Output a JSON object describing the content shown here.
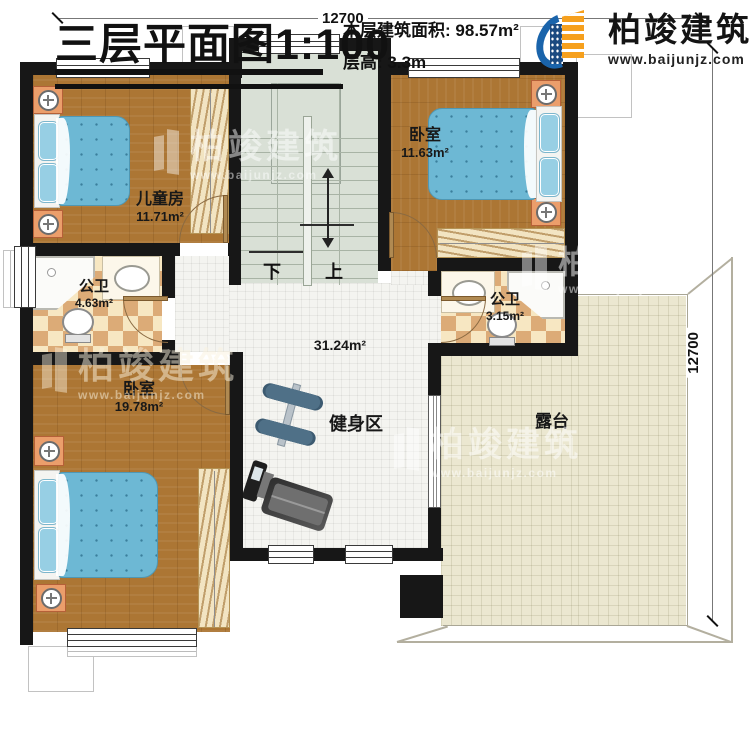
{
  "dimensions": {
    "top": "12700",
    "right": "12700"
  },
  "rooms": {
    "kids": {
      "name": "儿童房",
      "area": "11.71m²"
    },
    "bedroom_tr": {
      "name": "卧室",
      "area": "11.63m²"
    },
    "bath_left": {
      "name": "公卫",
      "area": "4.63m²"
    },
    "bath_right": {
      "name": "公卫",
      "area": "3.15m²"
    },
    "hall": {
      "area": "31.24m²",
      "zone": "健身区"
    },
    "bedroom_bl": {
      "name": "卧室",
      "area": "19.78m²"
    },
    "terrace": {
      "name": "露台"
    }
  },
  "stairs": {
    "down": "下",
    "up": "上"
  },
  "title_block": {
    "title": "三层平面图",
    "scale": "1:100",
    "area_label": "本层建筑面积:",
    "area_value": "98.57m²",
    "height_label": "层高:",
    "height_value": "3.3m"
  },
  "brand": {
    "name": "柏竣建筑",
    "website": "www.baijunjz.com"
  },
  "colors": {
    "wall": "#171717",
    "wood": "#ac7634",
    "bath_tile_light": "#f7e7c2",
    "bath_tile_dark": "#dcab77",
    "hall_tile": "#f4f4f0",
    "terrace_tile": "#ebe7d0",
    "stair_floor": "#d9e0d6",
    "bed_blue": "#6db8d4",
    "nightstand_orange": "#eb9e6b",
    "brand_blue": "#1a64ab",
    "brand_orange": "#f6a01d"
  }
}
